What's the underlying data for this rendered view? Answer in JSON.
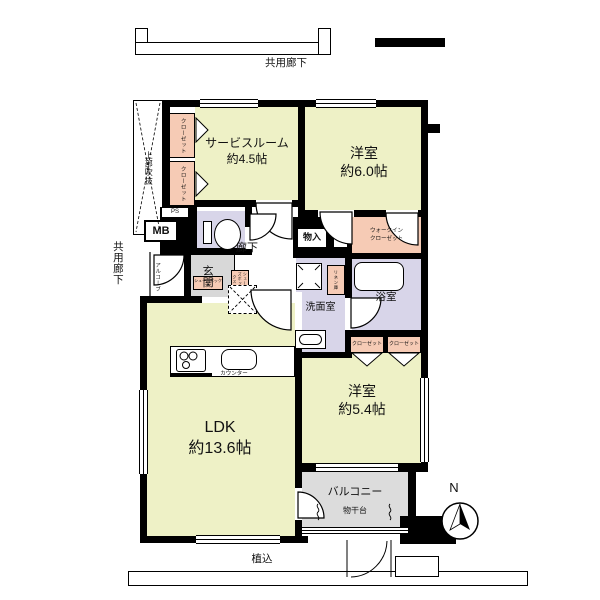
{
  "plan": {
    "corridor_top": "共用廊下",
    "corridor_left": "共用廊下",
    "void": "上部吹抜",
    "alcove": "アルコーブ",
    "entrance": "玄関",
    "hallway": "廊下",
    "planting": "植込",
    "north": "N"
  },
  "rooms": {
    "service": {
      "name": "サービスルーム",
      "area": "約4.5帖"
    },
    "bedroom6": {
      "name": "洋室",
      "area": "約6.0帖"
    },
    "bedroom5": {
      "name": "洋室",
      "area": "約5.4帖"
    },
    "ldk": {
      "name": "LDK",
      "area": "約13.6帖"
    }
  },
  "storage": {
    "closet": "クローゼット",
    "wic_line1": "ウォークイン",
    "wic_line2": "クローゼット",
    "storage_box": "物入",
    "linen": "リネン庫",
    "shoe_box": "シューズボックス"
  },
  "utility": {
    "mb": "MB",
    "ps": "PS",
    "washroom": "洗面室",
    "bath": "浴室",
    "counter": "カウンター"
  },
  "balcony": {
    "name": "バルコニー",
    "drying": "物干台"
  },
  "colors": {
    "room": "#eef1c6",
    "closet_pink": "#f6cbb5",
    "wet_lavender": "#d8d5e9",
    "entrance_gray": "#d8d8d8",
    "balcony_gray": "#dcdcdc",
    "wall": "#000000"
  }
}
